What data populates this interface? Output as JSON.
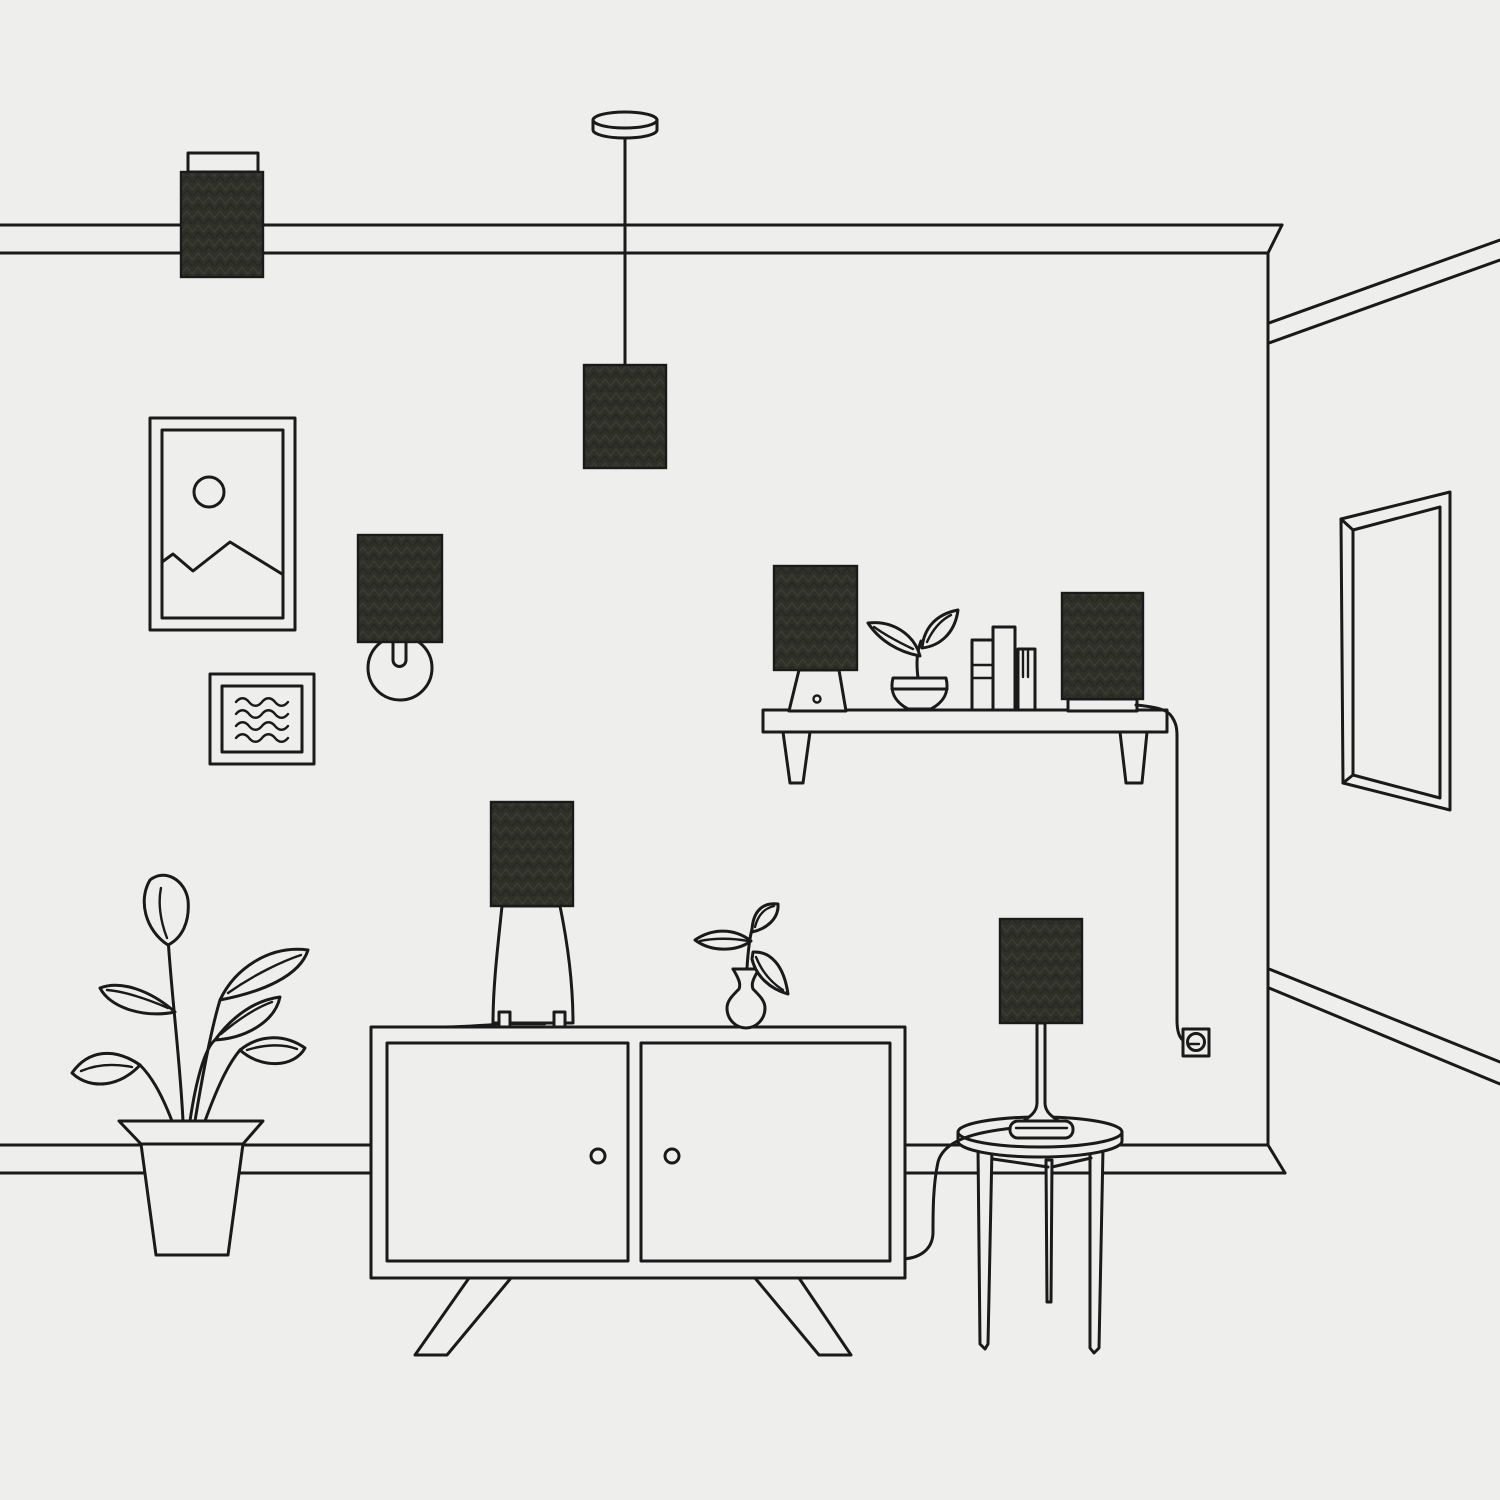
{
  "meta": {
    "title": "Minimal line-art living room illustration",
    "style": "single-weight outline drawing, flat light background, seven dark herringbone-textured lampshades",
    "canvas": {
      "width": 1500,
      "height": 1500
    }
  },
  "palette": {
    "background": "#eeefed",
    "line": "#1a1a1a",
    "shade_fill": "#2f3129",
    "shade_texture_light": "#3b3e33",
    "shade_texture_dark": "#242720",
    "surface": "#eeefed"
  },
  "scene": {
    "lampshade_count": 7,
    "objects": [
      {
        "id": "picture-rail",
        "label": "Picture rail molding across main wall and receding right wall"
      },
      {
        "id": "baseboard",
        "label": "Baseboard along main wall and receding right wall"
      },
      {
        "id": "wall-corner",
        "label": "Vertical wall corner on the right side"
      },
      {
        "id": "rail-box-lamp",
        "label": "Dark box lampshade with white cap resting over the picture rail, top left"
      },
      {
        "id": "pendant-lamp",
        "label": "Ceiling pendant lamp with round canopy, cord and dark shade"
      },
      {
        "id": "landscape-frame",
        "label": "Portrait picture frame with sun and mountains artwork"
      },
      {
        "id": "abstract-frame",
        "label": "Small square frame with four wavy lines"
      },
      {
        "id": "wall-sconce",
        "label": "Wall sconce: dark shade over round wall plate"
      },
      {
        "id": "wall-shelf",
        "label": "Wall shelf with two tapered brackets"
      },
      {
        "id": "shelf-table-lamp",
        "label": "Small table lamp with trapezoid base and button, on shelf"
      },
      {
        "id": "shelf-plant",
        "label": "Two-leaf potted plant on shelf"
      },
      {
        "id": "shelf-books",
        "label": "Three standing books on shelf",
        "count": 3
      },
      {
        "id": "shelf-speaker-lamp",
        "label": "Dark box speaker-style lamp on white base, on shelf"
      },
      {
        "id": "power-cord",
        "label": "Cord running from shelf lamp over shelf edge down to wall outlet"
      },
      {
        "id": "wall-outlet",
        "label": "Square wall outlet with round socket"
      },
      {
        "id": "wall-mirror",
        "label": "Tall rectangular mirror in perspective on right wall"
      },
      {
        "id": "floor-plant",
        "label": "Large leafy houseplant in tapered pot on floor, left"
      },
      {
        "id": "sideboard",
        "label": "Mid-century sideboard with two doors, round knobs and splayed legs"
      },
      {
        "id": "sideboard-table-lamp",
        "label": "Table lamp with bell body, two feet and dark shade on sideboard"
      },
      {
        "id": "flower-vase",
        "label": "Curvy vase with three-leaf sprig on sideboard"
      },
      {
        "id": "side-table",
        "label": "Round three-legged side table"
      },
      {
        "id": "side-table-lamp",
        "label": "Slim stem table lamp with dark shade on side table, cord draping to floor"
      }
    ]
  }
}
